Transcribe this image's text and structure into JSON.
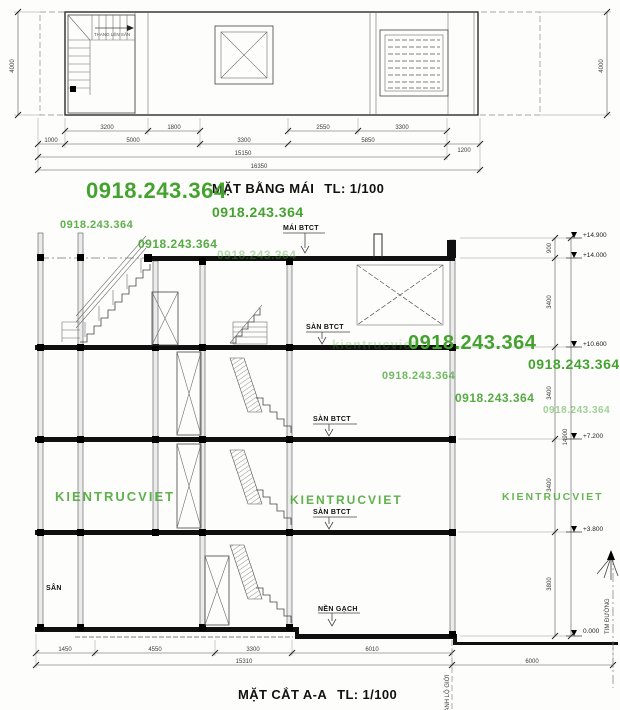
{
  "colors": {
    "watermark_green": "#44a32f",
    "ink": "#1c1c1c"
  },
  "watermarks": {
    "phone": "0918.243.364",
    "brand": "KIENTRUCVIET"
  },
  "roof_plan": {
    "title": "MẶT BẰNG MÁI",
    "scale_label": "TL: 1/100",
    "stair_note": "THANG LÊN SÂN",
    "dim_left_height": "4000",
    "dim_right_height": "4000",
    "dims_row1": [
      "3200",
      "1800",
      "2550",
      "3300"
    ],
    "dims_row2": [
      "1000",
      "5000",
      "3300",
      "5850",
      "1200"
    ],
    "dim_subtotal": "15150",
    "dim_total": "16350"
  },
  "section": {
    "title": "MẶT CẮT A-A",
    "scale_label": "TL: 1/100",
    "labels": {
      "roof_slab": "MÁI BTCT",
      "floor_slab": "SÀN BTCT",
      "ground_finish": "NỀN GẠCH",
      "yard": "SÂN",
      "boundary_line": "RANH LỘ GIỚI",
      "road_centerline": "TIM ĐƯỜNG"
    },
    "elevations": [
      "+14.900",
      "+14.000",
      "+10.600",
      "+7.200",
      "+3.800",
      "0.000"
    ],
    "vdims": [
      "900",
      "3400",
      "3400",
      "3400",
      "3800"
    ],
    "vdim_total": "14900",
    "hdims": [
      "1450",
      "4550",
      "3300",
      "6010"
    ],
    "hdim_total": "15310",
    "road_width_dim": "6000"
  }
}
